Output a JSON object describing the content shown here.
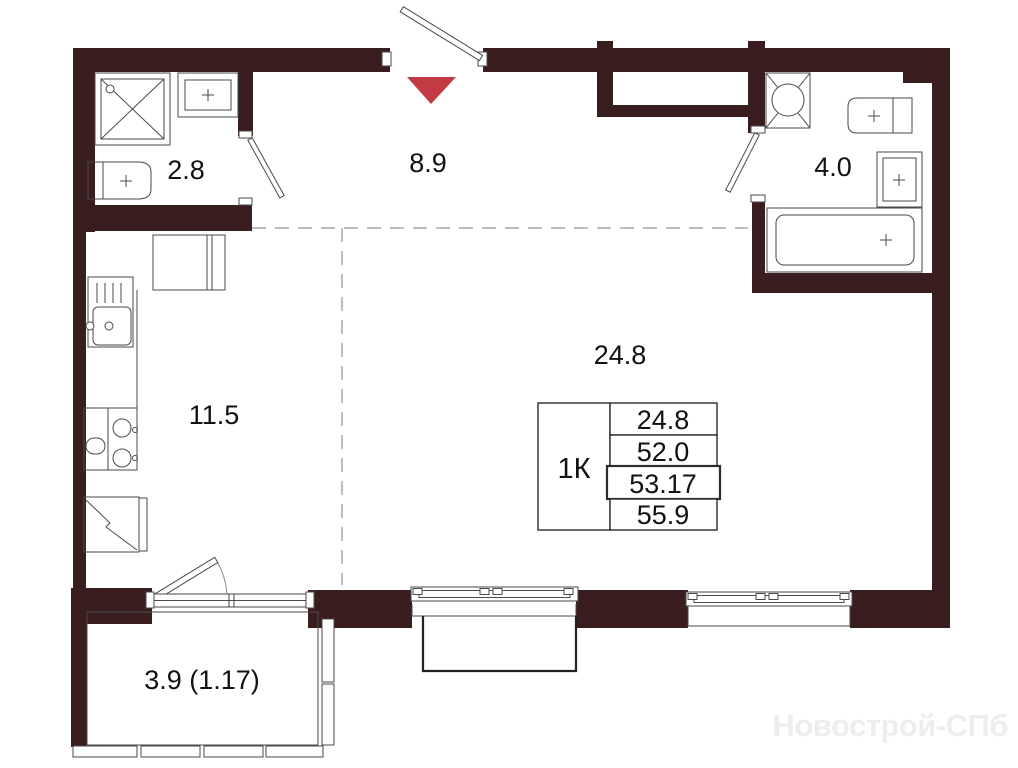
{
  "rooms": [
    {
      "id": "bathroom-small",
      "area": "2.8"
    },
    {
      "id": "hallway",
      "area": "8.9"
    },
    {
      "id": "bathroom",
      "area": "4.0"
    },
    {
      "id": "kitchen",
      "area": "11.5"
    },
    {
      "id": "living-room",
      "area": "24.8"
    },
    {
      "id": "balcony",
      "area": "3.9 (1.17)"
    }
  ],
  "info_table": {
    "unit_label": "1К",
    "values": [
      "24.8",
      "52.0",
      "53.17",
      "55.9"
    ]
  },
  "watermark": "Новострой-СПб",
  "colors": {
    "wall": "#3a1e1f",
    "arrow": "#c23b44",
    "line": "#4a4a4a",
    "dash": "#b9bdbf",
    "watermark": "#efecec",
    "label": "#111111",
    "outline": "#222222"
  }
}
